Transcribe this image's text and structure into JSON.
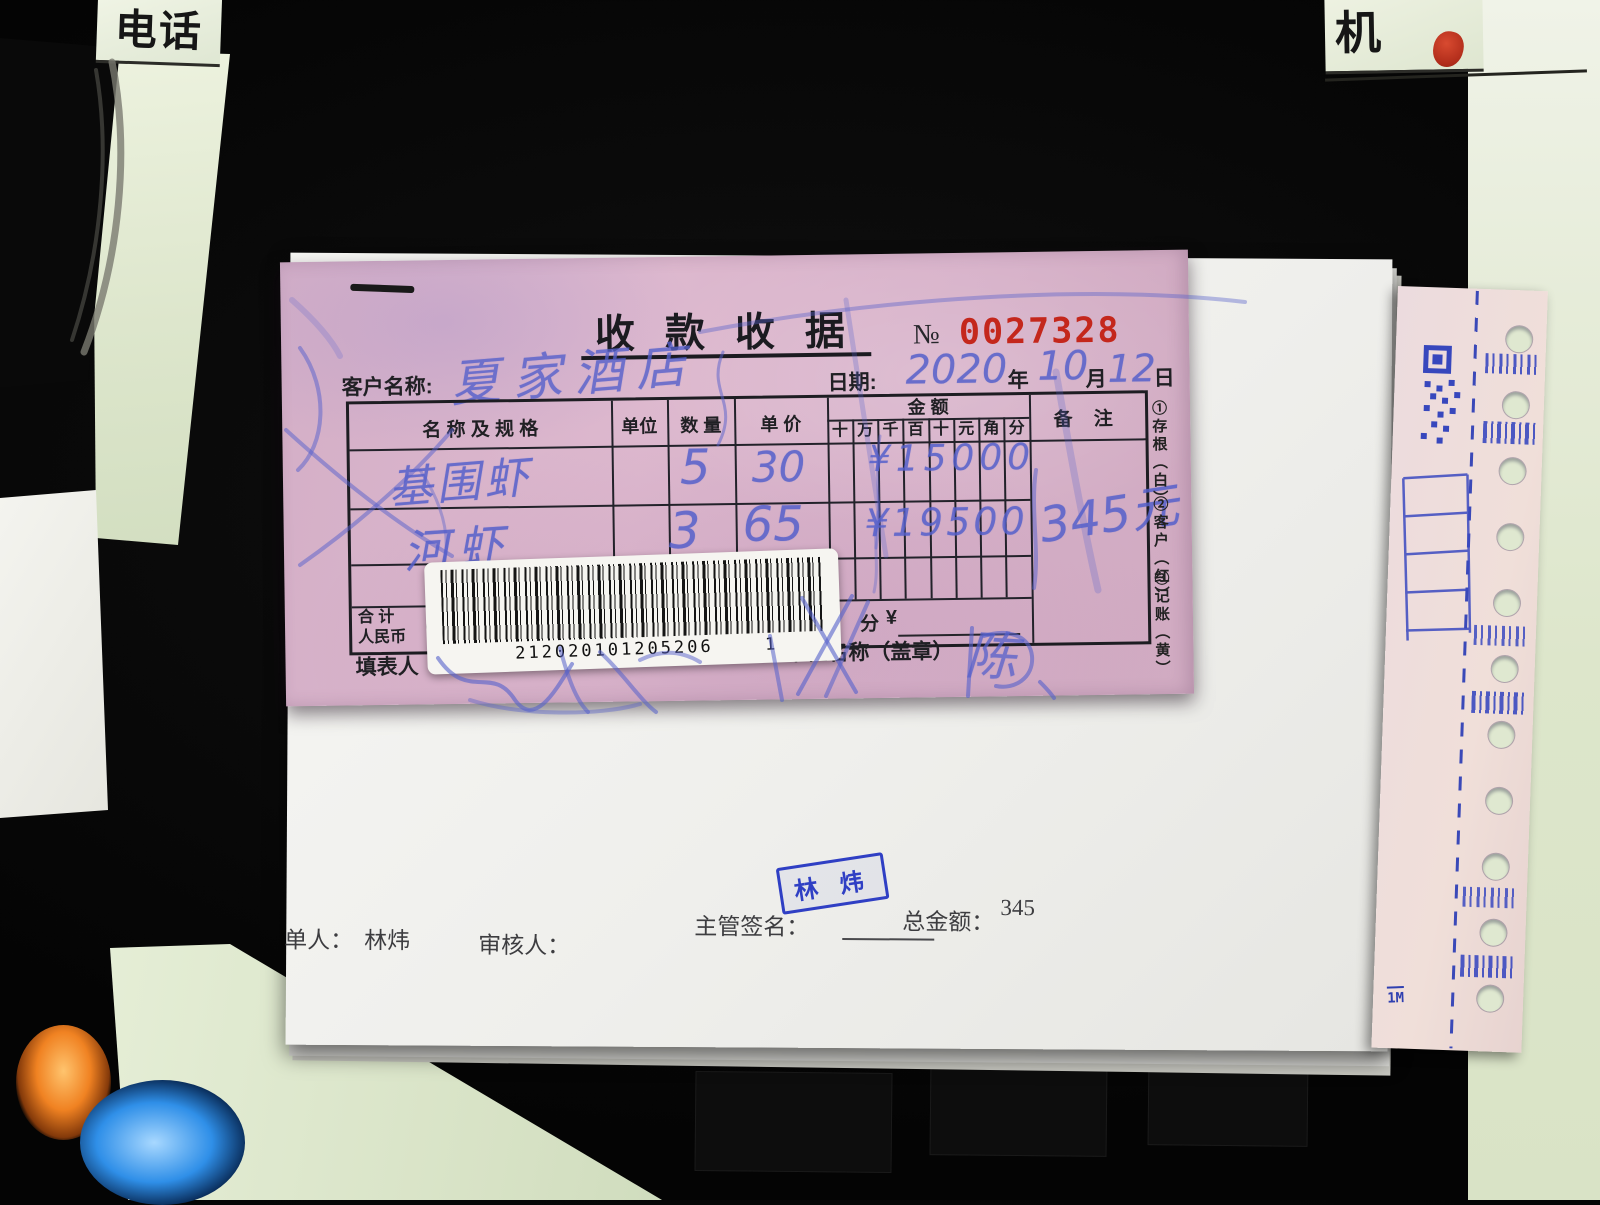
{
  "scene": {
    "top_left_label": "电话",
    "top_right_label": "机",
    "side_strip_mark": "1M"
  },
  "receipt": {
    "title": "收 款 收 据",
    "no_prefix": "№",
    "number": "0027328",
    "number_color": "#c4271c",
    "customer_label": "客户名称:",
    "customer_hand": "夏家酒店",
    "date": {
      "label": "日期:",
      "year_hand": "2020",
      "year": "年",
      "month_hand": "10",
      "month": "月",
      "day_hand": "12",
      "day": "日"
    },
    "table": {
      "col_name": "名 称 及 规 格",
      "col_unit": "单位",
      "col_qty": "数 量",
      "col_price": "单 价",
      "col_amount": "金  额",
      "col_remark": "备 注",
      "amount_digits": [
        "十",
        "万",
        "千",
        "百",
        "十",
        "元",
        "角",
        "分"
      ],
      "rows": [
        {
          "name": "基围虾",
          "qty": "5",
          "price": "30",
          "amount_hand": "¥15000",
          "amount_value": "150.00"
        },
        {
          "name": "河虾",
          "qty": "3",
          "price": "65",
          "amount_hand": "¥19500",
          "amount_value": "195.00"
        }
      ],
      "remark_hand": "345元",
      "total_label_1": "合  计",
      "total_label_2": "人民币",
      "total_paren": "（大",
      "total_units": [
        "拾",
        "元",
        "角",
        "分"
      ],
      "total_currency": "¥"
    },
    "copies": [
      "①存根（白）",
      "②客户（红）",
      "③记账（黄）"
    ],
    "filler_label": "填表人",
    "company_label": "单位名称（盖章）",
    "company_hand": "陈",
    "barcode": {
      "number": "212020101205206",
      "suffix": "1"
    }
  },
  "white_sheet": {
    "stamp": "林 炜",
    "maker_label": "单人：",
    "maker_value": "林炜",
    "auditor_label": "审核人：",
    "manager_label": "主管签名：",
    "total_label": "总金额：",
    "total_value": "345"
  }
}
